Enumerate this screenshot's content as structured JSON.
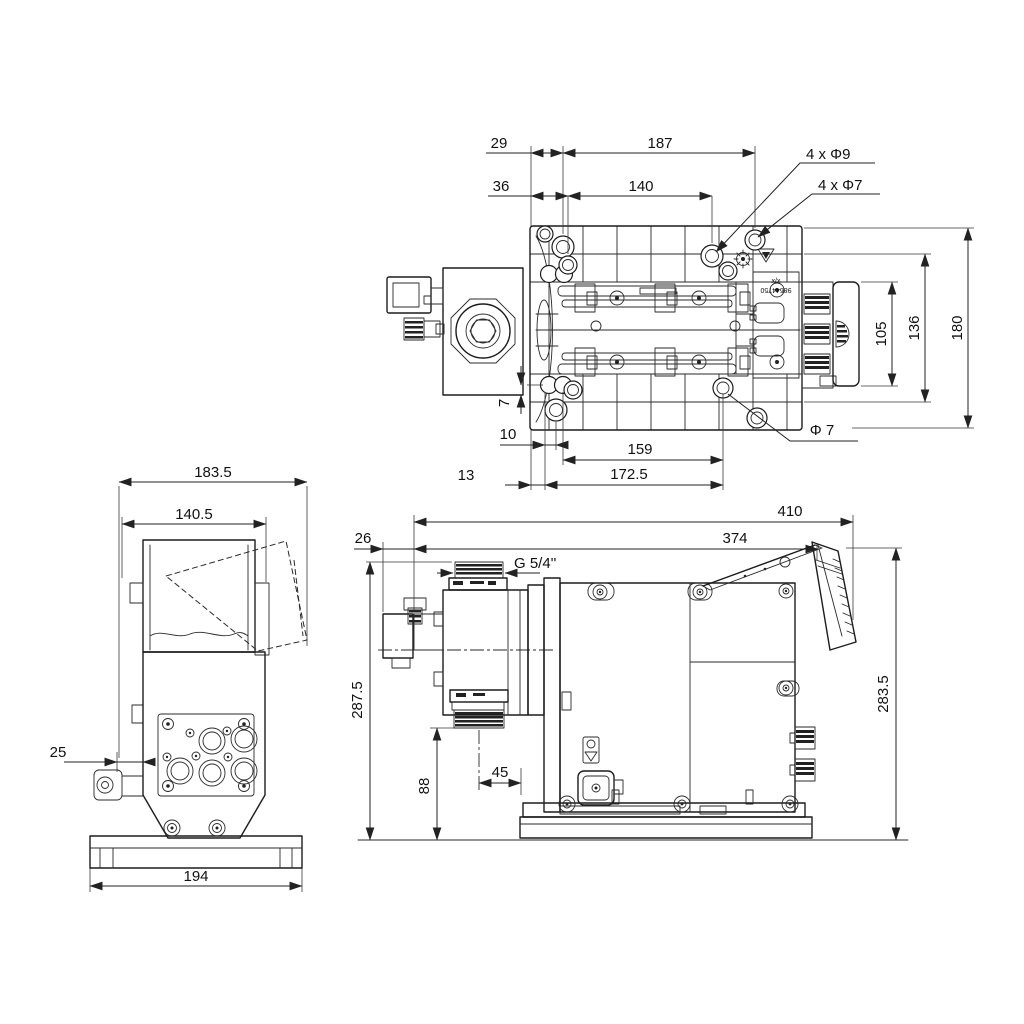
{
  "page": {
    "background": "#ffffff",
    "line_color": "#1c1c1c",
    "dim_color": "#111111"
  },
  "icons": {
    "starburst_icon": "✳",
    "warning_triangle_icon": "⚠",
    "drop_icon": "💧"
  },
  "views": {
    "top": {
      "d29": "29",
      "d187": "187",
      "d36": "36",
      "d140": "140",
      "c_phi9": "4 x Φ9",
      "c_phi7": "4 x Φ7",
      "d105": "105",
      "d136": "136",
      "d180": "180",
      "d7": "7",
      "d10": "10",
      "d159": "159",
      "d_phi7": "Φ 7",
      "d13": "13",
      "d172_5": "172.5",
      "plate_label_line1": "x/x",
      "plate_label_line2": "98644750"
    },
    "front": {
      "d183_5": "183.5",
      "d140_5": "140.5",
      "d25": "25",
      "d194": "194"
    },
    "side": {
      "d410": "410",
      "d26": "26",
      "d374": "374",
      "thread_label": "G 5/4''",
      "d287_5": "287.5",
      "d88": "88",
      "d45": "45",
      "d283_5": "283.5"
    }
  }
}
